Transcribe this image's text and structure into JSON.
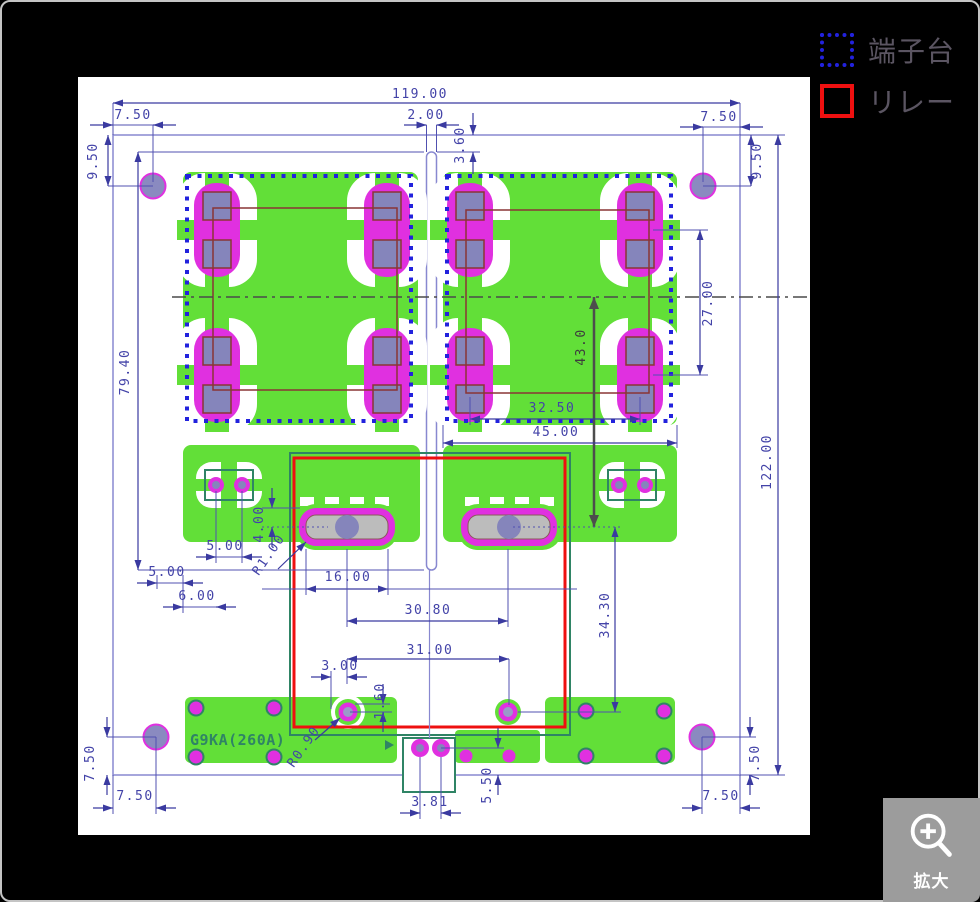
{
  "legend": {
    "terminal_label": "端子台",
    "relay_label": "リレー",
    "terminal_color": "#2222dd",
    "relay_color": "#ee1010"
  },
  "zoom_button": {
    "label": "拡大"
  },
  "drawing": {
    "part_label": "G9KA(260A)",
    "colors": {
      "copper_green": "#62df38",
      "pad_magenta": "#e030e0",
      "dimension_navy": "#3a3aa0",
      "terminal_outline_blue": "#2222dd",
      "relay_outline_red": "#ee1010",
      "silk_teal": "#2f8465"
    },
    "dims": {
      "width_total": "119.00",
      "height_total": "122.00",
      "offset_top_left": "7.50",
      "offset_top_right": "7.50",
      "hole_inset_left": "9.50",
      "hole_inset_right": "9.50",
      "slot_width": "2.00",
      "slot_top_gap": "3.60",
      "slot_length": "79.40",
      "pad_row_pitch": "27.00",
      "center_to_pad": "43.0",
      "pad_col_pitch": "32.50",
      "block_width": "45.00",
      "via_pitch": "5.00",
      "edge_gap": "5.00",
      "via_edge_offset": "6.00",
      "pad_top_offset": "4.00",
      "slot_pad_radius": "R1.00",
      "slot_pad_width": "16.00",
      "slot_pad_pitch": "30.80",
      "coil_pad_pitch": "31.00",
      "coil_offset_x": "3.00",
      "coil_offset_y": "1.60",
      "relay_depth": "34.30",
      "coil_pad_radius": "R0.90",
      "pin_pitch": "3.81",
      "pin_edge_gap": "5.50",
      "hole_bl_x": "7.50",
      "hole_bl_y": "7.50",
      "hole_br_x": "7.50",
      "hole_br_y": "7.50"
    }
  }
}
